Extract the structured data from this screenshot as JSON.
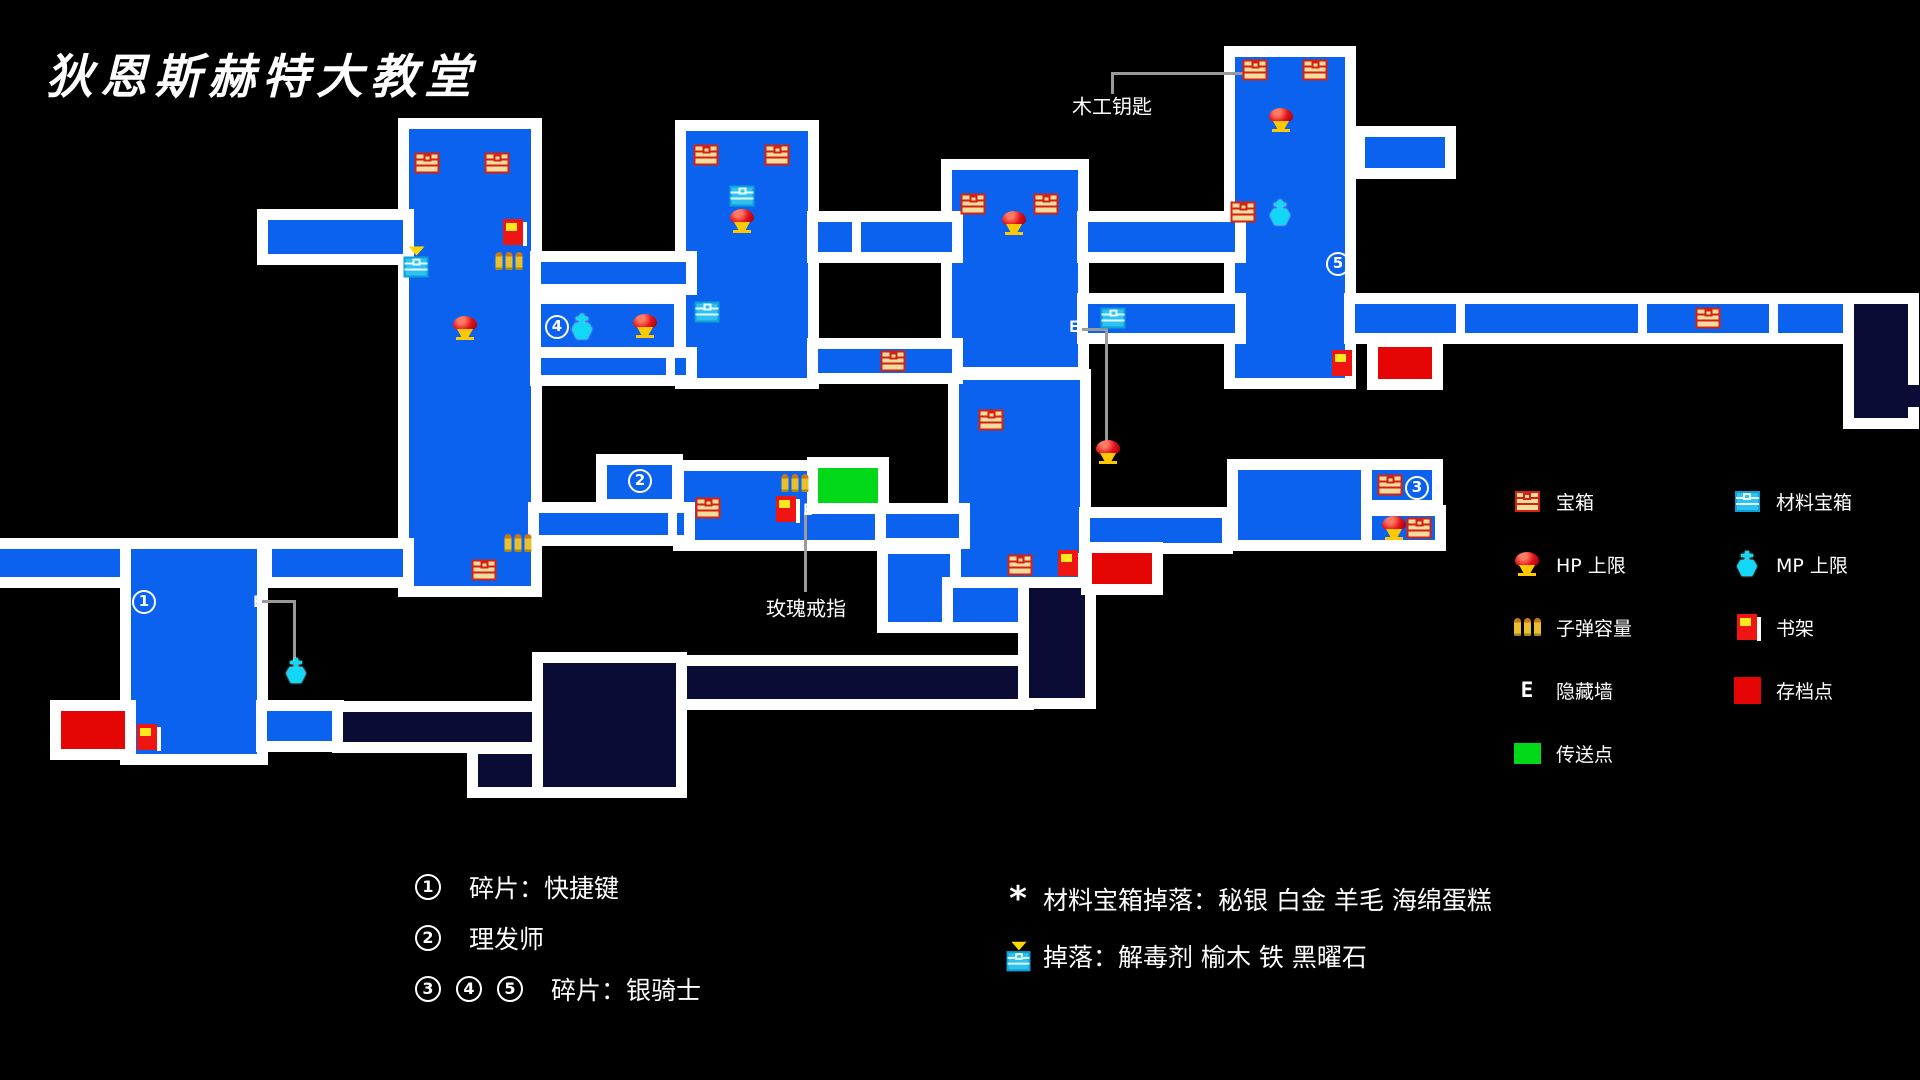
{
  "title": "狄恩斯赫特大教堂",
  "colors": {
    "room_blue": "#0a62ee",
    "room_dark": "#0a0c36",
    "save_red": "#e60505",
    "teleport_green": "#00d818",
    "border_white": "#ffffff",
    "line_gray": "#9a9a9a",
    "background": "#000000"
  },
  "map": {
    "rooms": [
      {
        "x": 409,
        "y": 129,
        "w": 122,
        "h": 457,
        "c": "b"
      },
      {
        "x": 686,
        "y": 131,
        "w": 122,
        "h": 247,
        "c": "b"
      },
      {
        "x": 952,
        "y": 170,
        "w": 126,
        "h": 197,
        "c": "b"
      },
      {
        "x": 1235,
        "y": 57,
        "w": 110,
        "h": 321,
        "c": "b"
      },
      {
        "x": 959,
        "y": 380,
        "w": 121,
        "h": 204,
        "c": "b"
      },
      {
        "x": 1238,
        "y": 470,
        "w": 125,
        "h": 70,
        "c": "b"
      },
      {
        "x": 131,
        "y": 549,
        "w": 126,
        "h": 205,
        "c": "b"
      },
      {
        "x": 684,
        "y": 471,
        "w": 192,
        "h": 69,
        "c": "b"
      },
      {
        "x": 888,
        "y": 554,
        "w": 62,
        "h": 68,
        "c": "b"
      },
      {
        "x": 953,
        "y": 588,
        "w": 70,
        "h": 34,
        "c": "b"
      },
      {
        "x": 268,
        "y": 220,
        "w": 135,
        "h": 34,
        "c": "b"
      },
      {
        "x": 541,
        "y": 262,
        "w": 145,
        "h": 22,
        "c": "b"
      },
      {
        "x": 541,
        "y": 304,
        "w": 133,
        "h": 45,
        "c": "b"
      },
      {
        "x": 541,
        "y": 358,
        "w": 145,
        "h": 17,
        "c": "b"
      },
      {
        "x": 818,
        "y": 222,
        "w": 134,
        "h": 30,
        "c": "b"
      },
      {
        "x": 818,
        "y": 349,
        "w": 134,
        "h": 24,
        "c": "b"
      },
      {
        "x": 1088,
        "y": 222,
        "w": 147,
        "h": 30,
        "c": "b"
      },
      {
        "x": 1088,
        "y": 304,
        "w": 147,
        "h": 29,
        "c": "b"
      },
      {
        "x": 1355,
        "y": 304,
        "w": 489,
        "h": 29,
        "c": "b"
      },
      {
        "x": 1365,
        "y": 137,
        "w": 80,
        "h": 31,
        "c": "b"
      },
      {
        "x": 0,
        "y": 549,
        "w": 120,
        "h": 28,
        "c": "b"
      },
      {
        "x": 272,
        "y": 549,
        "w": 131,
        "h": 28,
        "c": "b"
      },
      {
        "x": 539,
        "y": 513,
        "w": 145,
        "h": 22,
        "c": "b"
      },
      {
        "x": 886,
        "y": 514,
        "w": 73,
        "h": 24,
        "c": "b"
      },
      {
        "x": 1090,
        "y": 518,
        "w": 132,
        "h": 25,
        "c": "b"
      },
      {
        "x": 607,
        "y": 465,
        "w": 65,
        "h": 34,
        "c": "b"
      },
      {
        "x": 818,
        "y": 468,
        "w": 60,
        "h": 35,
        "c": "g"
      },
      {
        "x": 1372,
        "y": 470,
        "w": 60,
        "h": 30,
        "c": "b"
      },
      {
        "x": 1372,
        "y": 516,
        "w": 63,
        "h": 24,
        "c": "b"
      },
      {
        "x": 267,
        "y": 711,
        "w": 66,
        "h": 30,
        "c": "b"
      },
      {
        "x": 343,
        "y": 712,
        "w": 197,
        "h": 30,
        "c": "n"
      },
      {
        "x": 478,
        "y": 754,
        "w": 60,
        "h": 33,
        "c": "n"
      },
      {
        "x": 543,
        "y": 663,
        "w": 133,
        "h": 124,
        "c": "n"
      },
      {
        "x": 687,
        "y": 666,
        "w": 336,
        "h": 33,
        "c": "n"
      },
      {
        "x": 1029,
        "y": 588,
        "w": 56,
        "h": 110,
        "c": "n"
      },
      {
        "x": 1854,
        "y": 304,
        "w": 54,
        "h": 114,
        "c": "n"
      },
      {
        "x": 1908,
        "y": 385,
        "w": 12,
        "h": 22,
        "c": "n",
        "f": 1
      },
      {
        "x": 61,
        "y": 711,
        "w": 64,
        "h": 38,
        "c": "r"
      },
      {
        "x": 1092,
        "y": 553,
        "w": 60,
        "h": 31,
        "c": "r"
      },
      {
        "x": 1378,
        "y": 347,
        "w": 54,
        "h": 32,
        "c": "r"
      }
    ],
    "ticks": [
      {
        "x": 1456,
        "y": 304,
        "h": 29
      },
      {
        "x": 1638,
        "y": 304,
        "h": 29
      },
      {
        "x": 1769,
        "y": 304,
        "h": 29
      },
      {
        "x": 666,
        "y": 358,
        "h": 17
      },
      {
        "x": 852,
        "y": 222,
        "h": 30
      },
      {
        "x": 668,
        "y": 513,
        "h": 22
      }
    ],
    "lines": [
      {
        "x": 1111,
        "y": 72,
        "w": 132,
        "h": 3
      },
      {
        "x": 1111,
        "y": 72,
        "w": 3,
        "h": 22
      },
      {
        "x": 1082,
        "y": 328,
        "w": 26,
        "h": 3
      },
      {
        "x": 1105,
        "y": 328,
        "w": 3,
        "h": 114
      },
      {
        "x": 262,
        "y": 600,
        "w": 34,
        "h": 3
      },
      {
        "x": 293,
        "y": 600,
        "w": 3,
        "h": 62
      },
      {
        "x": 804,
        "y": 512,
        "w": 3,
        "h": 80
      }
    ],
    "annotations": [
      {
        "text": "木工钥匙",
        "x": 1112,
        "y": 105
      },
      {
        "text": "玫瑰戒指",
        "x": 806,
        "y": 607
      }
    ],
    "icons": [
      {
        "t": "chest",
        "x": 427,
        "y": 163
      },
      {
        "t": "chest",
        "x": 497,
        "y": 163
      },
      {
        "t": "chest",
        "x": 484,
        "y": 570
      },
      {
        "t": "chest",
        "x": 706,
        "y": 155
      },
      {
        "t": "chest",
        "x": 777,
        "y": 155
      },
      {
        "t": "chest",
        "x": 893,
        "y": 361
      },
      {
        "t": "chest",
        "x": 973,
        "y": 204
      },
      {
        "t": "chest",
        "x": 1046,
        "y": 204
      },
      {
        "t": "chest",
        "x": 1255,
        "y": 70
      },
      {
        "t": "chest",
        "x": 1315,
        "y": 70
      },
      {
        "t": "chest",
        "x": 1243,
        "y": 212
      },
      {
        "t": "chest",
        "x": 1708,
        "y": 318
      },
      {
        "t": "chest",
        "x": 708,
        "y": 508
      },
      {
        "t": "chest",
        "x": 991,
        "y": 420
      },
      {
        "t": "chest",
        "x": 1020,
        "y": 565
      },
      {
        "t": "chest",
        "x": 1390,
        "y": 485
      },
      {
        "t": "chest",
        "x": 1419,
        "y": 528
      },
      {
        "t": "matchest",
        "x": 742,
        "y": 196
      },
      {
        "t": "matchest",
        "x": 707,
        "y": 312
      },
      {
        "t": "matchest",
        "x": 1113,
        "y": 318
      },
      {
        "t": "matchest_marked",
        "x": 416,
        "y": 262
      },
      {
        "t": "hp",
        "x": 465,
        "y": 328
      },
      {
        "t": "hp",
        "x": 645,
        "y": 326
      },
      {
        "t": "hp",
        "x": 742,
        "y": 221
      },
      {
        "t": "hp",
        "x": 1014,
        "y": 223
      },
      {
        "t": "hp",
        "x": 1281,
        "y": 120
      },
      {
        "t": "hp",
        "x": 1108,
        "y": 452
      },
      {
        "t": "hp",
        "x": 1394,
        "y": 528
      },
      {
        "t": "mp",
        "x": 582,
        "y": 327
      },
      {
        "t": "mp",
        "x": 1280,
        "y": 213
      },
      {
        "t": "mp",
        "x": 296,
        "y": 671
      },
      {
        "t": "bullets",
        "x": 509,
        "y": 261
      },
      {
        "t": "bullets",
        "x": 518,
        "y": 543
      },
      {
        "t": "bullets",
        "x": 795,
        "y": 483
      },
      {
        "t": "book",
        "x": 513,
        "y": 232
      },
      {
        "t": "book",
        "x": 1342,
        "y": 363
      },
      {
        "t": "book",
        "x": 786,
        "y": 509
      },
      {
        "t": "book",
        "x": 1068,
        "y": 563
      },
      {
        "t": "book",
        "x": 147,
        "y": 737
      },
      {
        "t": "ewall",
        "x": 1074,
        "y": 327
      },
      {
        "t": "ewall",
        "x": 808,
        "y": 510
      },
      {
        "t": "ewall",
        "x": 258,
        "y": 602
      },
      {
        "t": "num",
        "v": "1",
        "x": 144,
        "y": 602
      },
      {
        "t": "num",
        "v": "2",
        "x": 640,
        "y": 481
      },
      {
        "t": "num",
        "v": "3",
        "x": 1417,
        "y": 488
      },
      {
        "t": "num",
        "v": "4",
        "x": 557,
        "y": 327
      },
      {
        "t": "num",
        "v": "5",
        "x": 1338,
        "y": 264
      }
    ]
  },
  "legend": {
    "left": [
      {
        "icon": "chest",
        "label": "宝箱"
      },
      {
        "icon": "hp",
        "label": "HP 上限"
      },
      {
        "icon": "bullets",
        "label": "子弹容量"
      },
      {
        "icon": "ewall",
        "label": "隐藏墙"
      },
      {
        "icon": "teleport",
        "label": "传送点"
      }
    ],
    "right": [
      {
        "icon": "matchest",
        "label": "材料宝箱"
      },
      {
        "icon": "mp",
        "label": "MP 上限"
      },
      {
        "icon": "book",
        "label": "书架"
      },
      {
        "icon": "save",
        "label": "存档点"
      }
    ]
  },
  "notes": {
    "left": [
      {
        "nums": [
          "1"
        ],
        "text": "碎片：快捷键"
      },
      {
        "nums": [
          "2"
        ],
        "text": "理发师"
      },
      {
        "nums": [
          "3",
          "4",
          "5"
        ],
        "text": "碎片：银骑士"
      }
    ],
    "right": [
      {
        "marker": "asterisk",
        "marker_glyph": "*",
        "text": "材料宝箱掉落：秘银 白金 羊毛 海绵蛋糕"
      },
      {
        "marker": "matchest_marked",
        "text": "掉落：解毒剂 榆木 铁 黑曜石"
      }
    ]
  }
}
